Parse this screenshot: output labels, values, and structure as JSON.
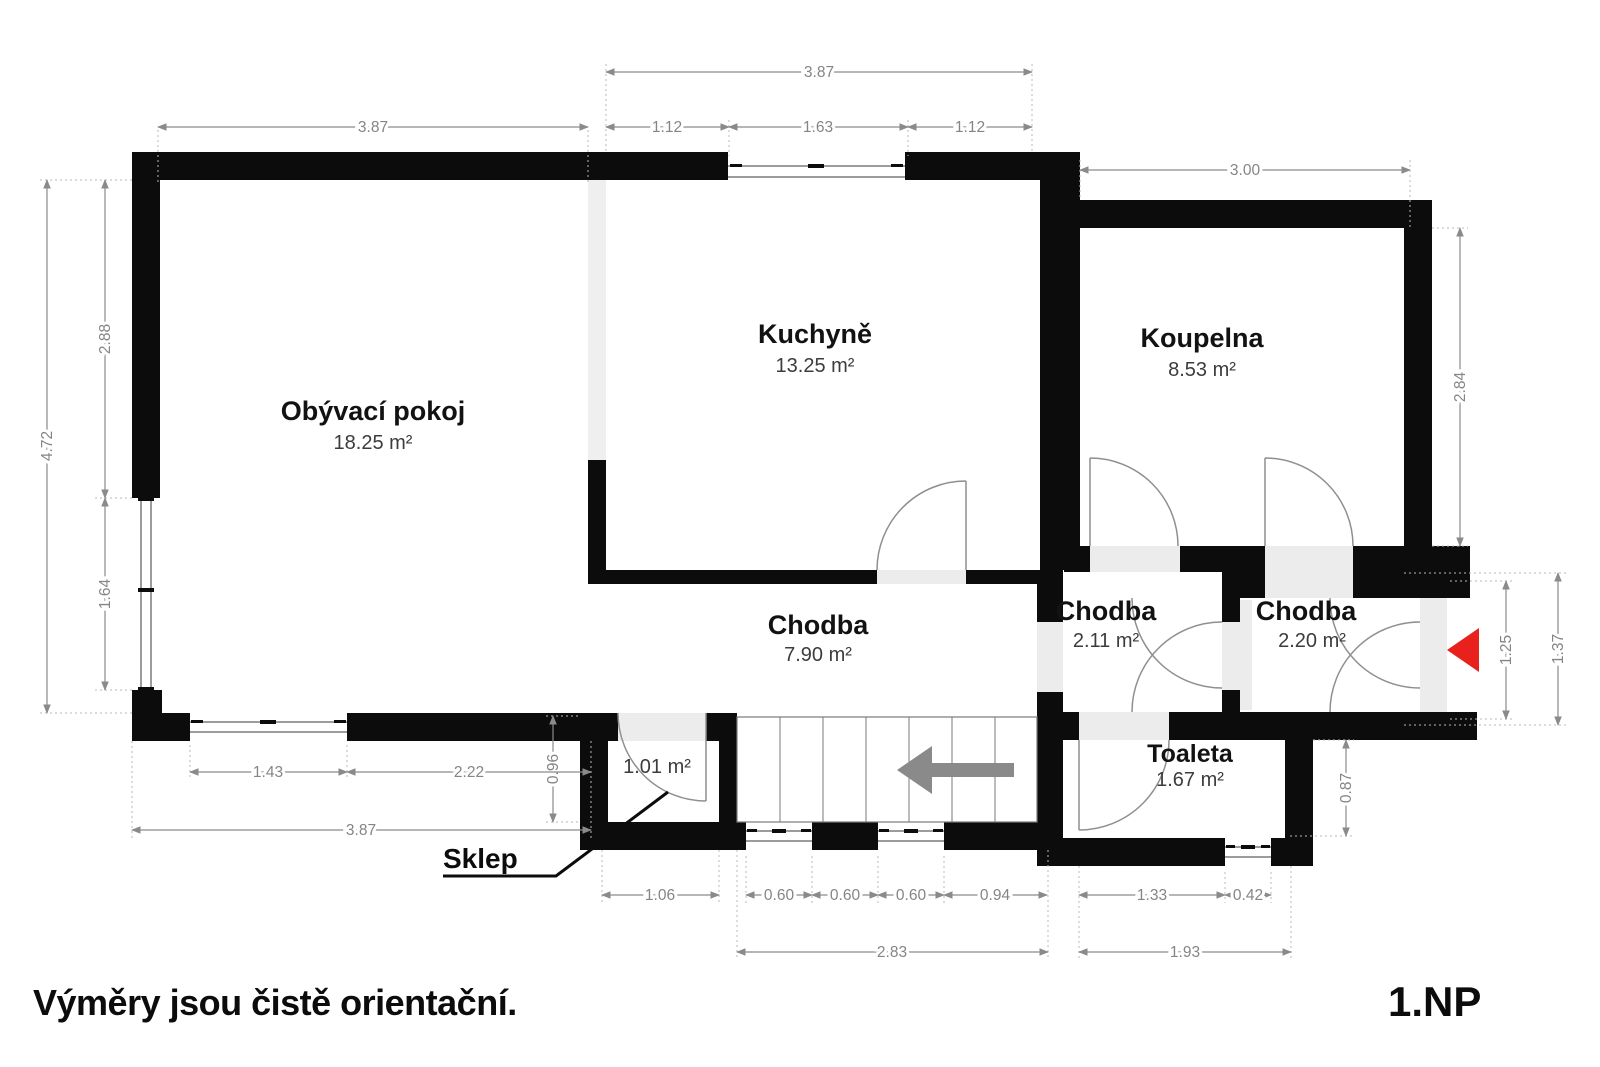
{
  "title": "Floor plan 1.NP",
  "footer": {
    "disclaimer": "Výměry jsou čistě orientační.",
    "floor_label": "1.NP"
  },
  "rooms": {
    "living": {
      "name": "Obývací pokoj",
      "area": "18.25 m²"
    },
    "kitchen": {
      "name": "Kuchyně",
      "area": "13.25 m²"
    },
    "bathroom": {
      "name": "Koupelna",
      "area": "8.53 m²"
    },
    "hallway": {
      "name": "Chodba",
      "area": "7.90 m²"
    },
    "hallway_a": {
      "name": "Chodba",
      "area": "2.11 m²"
    },
    "hallway_b": {
      "name": "Chodba",
      "area": "2.20 m²"
    },
    "toilet": {
      "name": "Toaleta",
      "area": "1.67 m²"
    },
    "cellar": {
      "name": "Sklep",
      "area": "1.01 m²"
    }
  },
  "dimensions": {
    "top_kitchen_total": "3.87",
    "top_living": "3.87",
    "top_kitchen_left": "1.12",
    "top_kitchen_window": "1.63",
    "top_kitchen_right": "1.12",
    "top_bath": "3.00",
    "left_total": "4.72",
    "left_upper": "2.88",
    "left_window": "1.64",
    "right_bath": "2.84",
    "right_entry_inner": "1.25",
    "right_entry_outer": "1.37",
    "toilet_side": "0.87",
    "cellar_step": "0.96",
    "bottom_window_left": "1.43",
    "bottom_wall_left": "2.22",
    "bottom_left_total": "3.87",
    "bottom_cellar": "1.06",
    "bottom_win1": "0.60",
    "bottom_win2": "0.60",
    "bottom_win3": "0.60",
    "bottom_right_span": "0.94",
    "bottom_stairs_total": "2.83",
    "bottom_toilet_left": "1.33",
    "bottom_toilet_window": "0.42",
    "bottom_toilet_total": "1.93"
  },
  "icons": {
    "entrance_arrow": "red-arrow-left (main entrance)",
    "stairs_arrow": "gray-arrow-left (stairs direction)"
  },
  "colors": {
    "wall": "#0c0c0c",
    "accent_red": "#e8211d",
    "dimension_gray": "#8a8a8a",
    "threshold_gray": "#ececec"
  }
}
